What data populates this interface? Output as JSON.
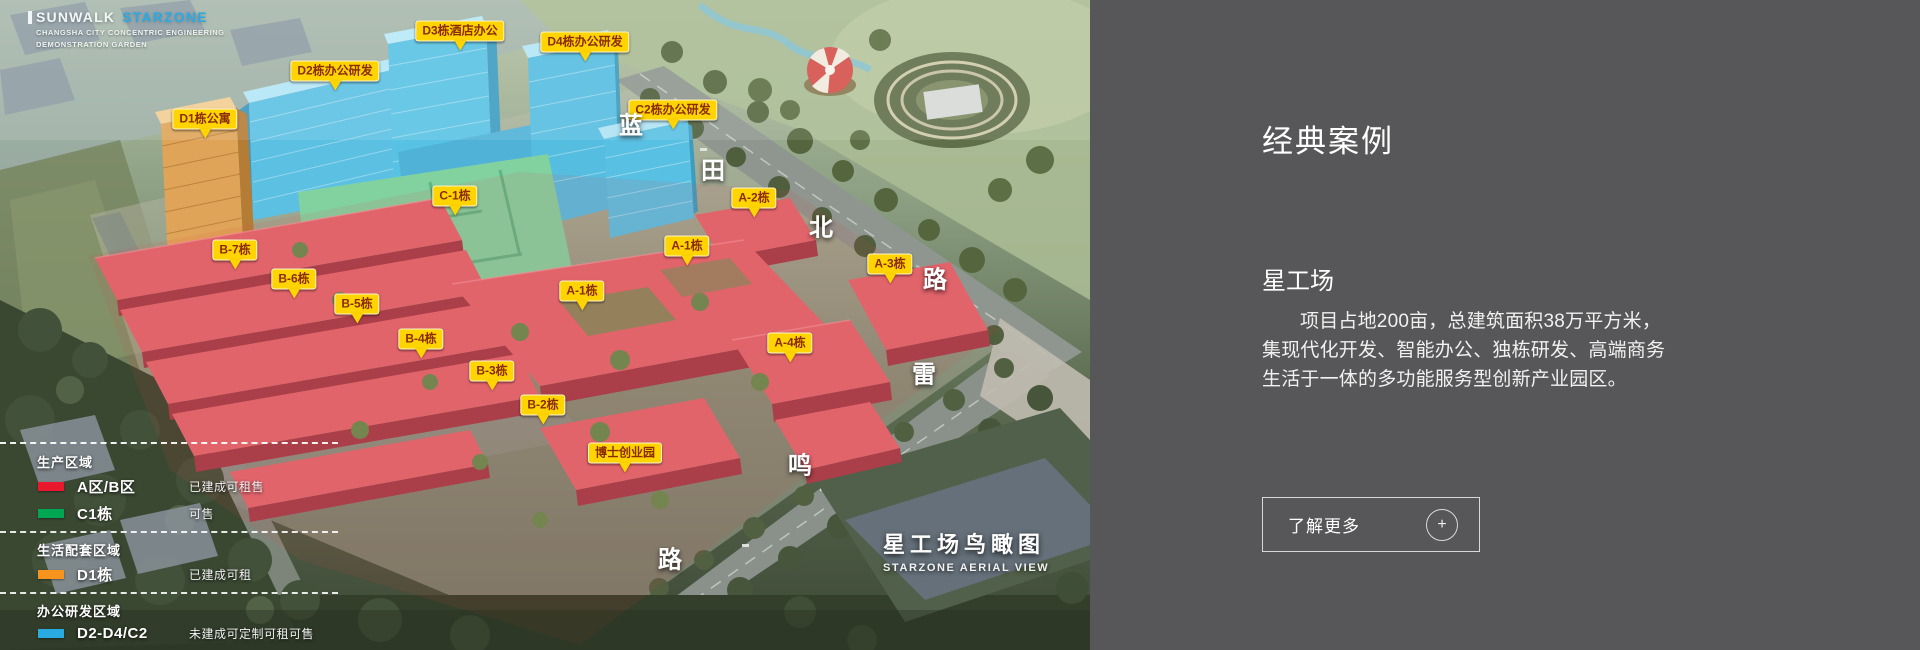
{
  "logo": {
    "brand_primary": "SUNWALK",
    "brand_secondary": "STARZONE",
    "subtitle_line1": "CHANGSHA CITY CONCENTRIC ENGINEERING",
    "subtitle_line2": "DEMONSTRATION GARDEN"
  },
  "map": {
    "title": "星工场鸟瞰图",
    "title_en": "STARZONE AERIAL VIEW",
    "building_labels": [
      {
        "text": "D1栋公寓",
        "x": 205,
        "y": 119
      },
      {
        "text": "D2栋办公研发",
        "x": 335,
        "y": 71
      },
      {
        "text": "D3栋酒店办公",
        "x": 460,
        "y": 31
      },
      {
        "text": "D4栋办公研发",
        "x": 585,
        "y": 42
      },
      {
        "text": "C2栋办公研发",
        "x": 673,
        "y": 110
      },
      {
        "text": "C-1栋",
        "x": 455,
        "y": 196
      },
      {
        "text": "B-7栋",
        "x": 235,
        "y": 250
      },
      {
        "text": "B-6栋",
        "x": 294,
        "y": 279
      },
      {
        "text": "B-5栋",
        "x": 357,
        "y": 304
      },
      {
        "text": "B-4栋",
        "x": 421,
        "y": 339
      },
      {
        "text": "B-3栋",
        "x": 492,
        "y": 371
      },
      {
        "text": "B-2栋",
        "x": 543,
        "y": 405
      },
      {
        "text": "A-2栋",
        "x": 754,
        "y": 198
      },
      {
        "text": "A-1栋",
        "x": 687,
        "y": 246
      },
      {
        "text": "A-1栋",
        "x": 582,
        "y": 291
      },
      {
        "text": "A-3栋",
        "x": 890,
        "y": 264
      },
      {
        "text": "A-4栋",
        "x": 790,
        "y": 343
      },
      {
        "text": "博士创业园",
        "x": 625,
        "y": 453
      }
    ],
    "road_characters": [
      {
        "char": "蓝",
        "x": 631,
        "y": 123
      },
      {
        "char": "田",
        "x": 713,
        "y": 168
      },
      {
        "char": "北",
        "x": 821,
        "y": 225
      },
      {
        "char": "路",
        "x": 935,
        "y": 277
      },
      {
        "char": "雷",
        "x": 924,
        "y": 372
      },
      {
        "char": "鸣",
        "x": 800,
        "y": 463
      },
      {
        "char": "路",
        "x": 670,
        "y": 557
      }
    ],
    "legend": {
      "groups": [
        {
          "header": "生产区域",
          "rows": [
            {
              "swatch": "#e8192c",
              "name": "A区/B区",
              "status": "已建成可租售"
            },
            {
              "swatch": "#00a651",
              "name": "C1栋",
              "status": "可售"
            }
          ]
        },
        {
          "header": "生活配套区域",
          "rows": [
            {
              "swatch": "#f7941d",
              "name": "D1栋",
              "status": "已建成可租"
            }
          ]
        },
        {
          "header": "办公研发区域",
          "rows": [
            {
              "swatch": "#29abe2",
              "name": "D2-D4/C2",
              "status": "未建成可定制可租可售"
            }
          ]
        }
      ]
    },
    "colors": {
      "label_yellow": "#ffd400",
      "label_text": "#8a2b00",
      "zone_red": "#e2646b",
      "zone_green": "#82d2a0",
      "zone_blue": "#5cc0e2",
      "zone_orange": "#dfa458"
    }
  },
  "panel": {
    "heading": "经典案例",
    "project_name": "星工场",
    "description": "项目占地200亩，总建筑面积38万平方米，集现代化开发、智能办公、独栋研发、高端商务生活于一体的多功能服务型创新产业园区。",
    "more_button": "了解更多",
    "plus_icon": "+",
    "colors": {
      "panel_bg": "#575759",
      "accent_blue": "#29abe2"
    }
  }
}
